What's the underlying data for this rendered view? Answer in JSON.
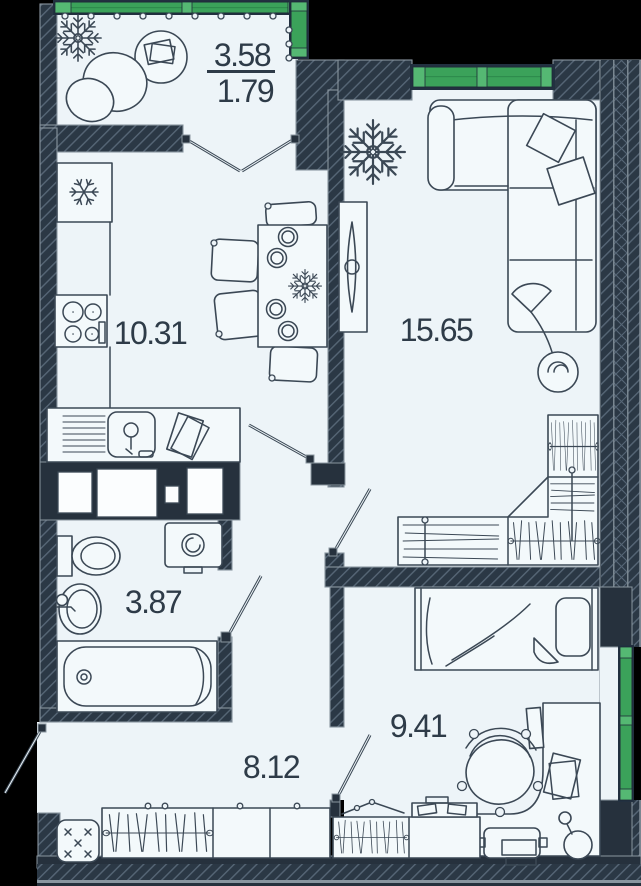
{
  "plan": {
    "rooms": [
      {
        "name": "balcony",
        "area": "3.58",
        "area_reduced": "1.79"
      },
      {
        "name": "kitchen-dining",
        "area": "10.31"
      },
      {
        "name": "living-room",
        "area": "15.65"
      },
      {
        "name": "bathroom",
        "area": "3.87"
      },
      {
        "name": "hallway",
        "area": "8.12"
      },
      {
        "name": "bedroom",
        "area": "9.41"
      }
    ],
    "colors": {
      "background": "#000000",
      "floor": "#edf4f8",
      "walls": "#2b3845",
      "wall_hatch": "#5a6a77",
      "window_green": "#3ba25a",
      "furniture_line": "#3b4855",
      "label_text": "#2e3b48"
    },
    "icons": [
      "snowflake-fridge-icon",
      "stove-icon",
      "kitchen-sink-icon",
      "dining-table-icon",
      "plant-icon",
      "tv-icon",
      "sofa-icon",
      "wardrobe-hangers-icon",
      "wardrobe-shelves-icon",
      "toilet-icon",
      "washing-machine-icon",
      "bath-sink-icon",
      "bathtub-icon",
      "bed-icon",
      "desk-icon",
      "office-chair-icon",
      "printer-icon",
      "desk-lamp-icon",
      "pouf-icon"
    ]
  }
}
